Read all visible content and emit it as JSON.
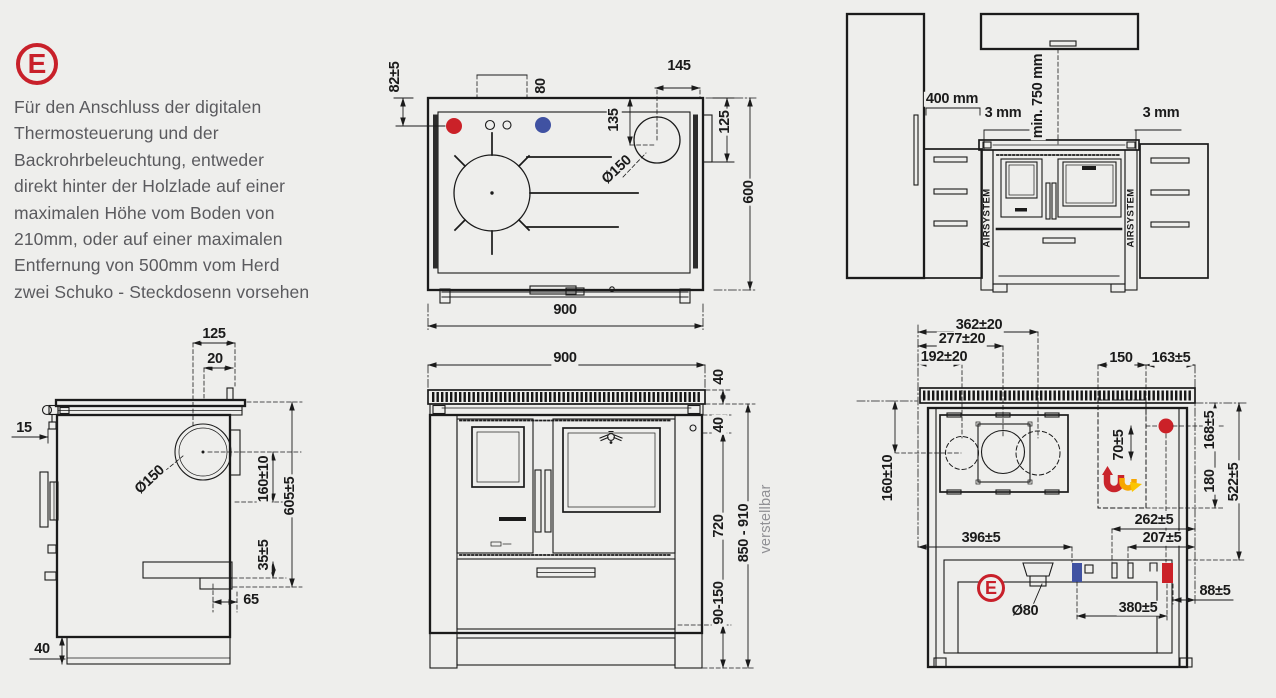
{
  "colors": {
    "background": "#eeeeec",
    "line": "#1b1b1b",
    "logo_red": "#c8202a",
    "marker_red": "#cb2128",
    "marker_blue": "#4052a2",
    "flame_orange": "#f7a600",
    "flame_yellow": "#fbc500",
    "muted_text": "#5a5a5e"
  },
  "note": {
    "logo_letter": "E",
    "text": "Für den Anschluss der digitalen\nThermosteuerung und der\nBackrohrbeleuchtung, entweder\ndirekt hinter der Holzlade auf einer\nmaximalen Höhe vom Boden von\n210mm, oder auf einer maximalen\nEntfernung von 500mm vom Herd\nzwei Schuko - Steckdosenn vorsehen"
  },
  "top_view": {
    "d82": "82±5",
    "d80": "80",
    "d145": "145",
    "d135": "135",
    "d125": "125",
    "d600": "600",
    "d900": "900",
    "d_diam": "Ø150"
  },
  "kitchen_view": {
    "d400": "400 mm",
    "d3_left": "3 mm",
    "d750": "min. 750 mm",
    "d3_right": "3 mm",
    "airsystem_left": "AIRSYSTEM",
    "airsystem_right": "AIRSYSTEM"
  },
  "side_view": {
    "d125": "125",
    "d20": "20",
    "d15": "15",
    "d_diam": "Ø150",
    "d160": "160±10",
    "d605": "605±5",
    "d35": "35±5",
    "d65": "65",
    "d40": "40"
  },
  "front_view": {
    "d900": "900",
    "d40_top": "40",
    "d40_mid": "40",
    "d720": "720",
    "d90_150": "90-150",
    "d850_910": "850 - 910",
    "adjustable": "verstellbar"
  },
  "rear_view": {
    "logo_letter": "E",
    "d362": "362±20",
    "d277": "277±20",
    "d192": "192±20",
    "d150": "150",
    "d163": "163±5",
    "d70": "70±5",
    "d168": "168±5",
    "d180": "180",
    "d522": "522±5",
    "d160": "160±10",
    "d262": "262±5",
    "d207": "207±5",
    "d396": "396±5",
    "d_diam": "Ø80",
    "d380": "380±5",
    "d88": "88±5"
  }
}
